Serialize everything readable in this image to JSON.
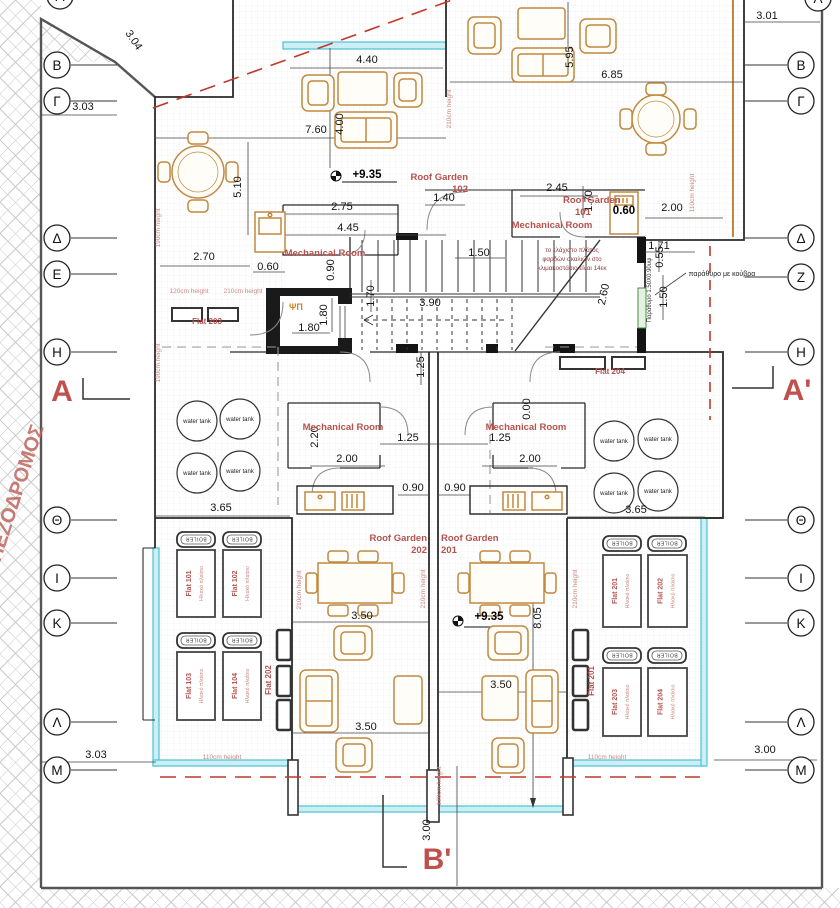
{
  "drawing": {
    "type": "architectural roof plan",
    "pedestrian_street_label": "ΠΕΖΟΔΡΟΜΟΣ",
    "accent_colors": {
      "annotation_red": "#b5524e",
      "section_red": "#c0504d",
      "glass_teal": "#49c3d4",
      "furniture_tan": "#c08840",
      "setback_dash_red": "#c0392b"
    }
  },
  "grid_markers": {
    "left": [
      [
        "Β",
        65
      ],
      [
        "Γ",
        101
      ],
      [
        "Δ",
        238
      ],
      [
        "Ε",
        274
      ],
      [
        "Η",
        352
      ],
      [
        "Θ",
        520
      ],
      [
        "Ι",
        578
      ],
      [
        "Κ",
        623
      ],
      [
        "Λ",
        722
      ],
      [
        "Μ",
        770
      ]
    ],
    "right": [
      [
        "Β",
        65
      ],
      [
        "Γ",
        101
      ],
      [
        "Δ",
        238
      ],
      [
        "Ζ",
        277
      ],
      [
        "Η",
        352
      ],
      [
        "Θ",
        520
      ],
      [
        "Ι",
        578
      ],
      [
        "Κ",
        623
      ],
      [
        "Λ",
        722
      ],
      [
        "Μ",
        770
      ]
    ],
    "top_partial_letter": "Α"
  },
  "section_markers": [
    {
      "t": "A",
      "x": 62,
      "y": 401
    },
    {
      "t": "A'",
      "x": 797,
      "y": 400
    },
    {
      "t": "B'",
      "x": 437,
      "y": 869
    }
  ],
  "water_tank_label": "water tank",
  "water_tanks": [
    [
      197,
      421
    ],
    [
      240,
      419
    ],
    [
      197,
      473
    ],
    [
      240,
      471
    ],
    [
      614,
      441
    ],
    [
      658,
      439
    ],
    [
      614,
      493
    ],
    [
      658,
      491
    ]
  ],
  "solar_panel_sub_label": "Ηλιακό πλαίσιο",
  "boiler_label": "BOILER",
  "solar_panels": [
    [
      "Flat 101",
      177,
      550,
      38,
      67
    ],
    [
      "Flat 102",
      223,
      550,
      38,
      67
    ],
    [
      "Flat 103",
      177,
      652,
      38,
      68
    ],
    [
      "Flat 104",
      223,
      652,
      38,
      68
    ],
    [
      "Flat 201",
      603,
      555,
      38,
      72
    ],
    [
      "Flat 202",
      648,
      555,
      39,
      72
    ],
    [
      "Flat 203",
      603,
      668,
      38,
      68
    ],
    [
      "Flat 204",
      648,
      668,
      39,
      68
    ]
  ],
  "boilers": [
    [
      177,
      532
    ],
    [
      223,
      532
    ],
    [
      177,
      633
    ],
    [
      223,
      633
    ],
    [
      603,
      536
    ],
    [
      648,
      536
    ],
    [
      603,
      648
    ],
    [
      648,
      648
    ]
  ],
  "texts": [
    {
      "t": "3.01",
      "x": 767,
      "y": 19,
      "c": "dim"
    },
    {
      "t": "3.04",
      "x": 131,
      "y": 42,
      "r": 56,
      "c": "dim"
    },
    {
      "t": "3.03",
      "x": 83,
      "y": 110,
      "c": "dim"
    },
    {
      "t": "4.40",
      "x": 367,
      "y": 63,
      "c": "dim"
    },
    {
      "t": "6.85",
      "x": 612,
      "y": 78,
      "c": "dim"
    },
    {
      "t": "5.95",
      "x": 573,
      "y": 57,
      "r": -90,
      "c": "dim"
    },
    {
      "t": "7.60",
      "x": 316,
      "y": 133,
      "c": "dim"
    },
    {
      "t": "4.00",
      "x": 343,
      "y": 124,
      "r": -90,
      "c": "dim"
    },
    {
      "t": "5.10",
      "x": 241,
      "y": 187,
      "r": -90,
      "c": "dim"
    },
    {
      "t": "1.40",
      "x": 444,
      "y": 201,
      "c": "dim"
    },
    {
      "t": "2.45",
      "x": 557,
      "y": 191,
      "c": "dim"
    },
    {
      "t": "1.70",
      "x": 592,
      "y": 201,
      "r": -90,
      "c": "dim"
    },
    {
      "t": "0.60",
      "x": 624,
      "y": 214,
      "c": "dimb"
    },
    {
      "t": "2.00",
      "x": 672,
      "y": 211,
      "c": "dim"
    },
    {
      "t": "2.75",
      "x": 342,
      "y": 210,
      "c": "dim"
    },
    {
      "t": "4.45",
      "x": 348,
      "y": 231,
      "c": "dim"
    },
    {
      "t": "2.70",
      "x": 204,
      "y": 260,
      "c": "dim"
    },
    {
      "t": "0.60",
      "x": 268,
      "y": 270,
      "c": "dim"
    },
    {
      "t": "1.50",
      "x": 479,
      "y": 256,
      "c": "dim"
    },
    {
      "t": "1.71",
      "x": 659,
      "y": 249,
      "c": "dim"
    },
    {
      "t": "0.55",
      "x": 663,
      "y": 257,
      "r": -90,
      "c": "dim"
    },
    {
      "t": "1.50",
      "x": 667,
      "y": 297,
      "r": -90,
      "c": "dim"
    },
    {
      "t": "1.80",
      "x": 309,
      "y": 331,
      "c": "dim"
    },
    {
      "t": "1.80",
      "x": 327,
      "y": 315,
      "r": -90,
      "c": "dim"
    },
    {
      "t": "0.90",
      "x": 334,
      "y": 270,
      "r": -90,
      "c": "dim"
    },
    {
      "t": "1.70",
      "x": 374,
      "y": 296,
      "r": -90,
      "c": "dim"
    },
    {
      "t": "3.90",
      "x": 430,
      "y": 306,
      "c": "dim"
    },
    {
      "t": "2.60",
      "x": 607,
      "y": 295,
      "r": -78,
      "c": "dim"
    },
    {
      "t": "1.25",
      "x": 424,
      "y": 367,
      "r": -90,
      "c": "dim"
    },
    {
      "t": "0.00",
      "x": 530,
      "y": 409,
      "r": -90,
      "c": "dim"
    },
    {
      "t": "2.20",
      "x": 318,
      "y": 437,
      "r": -90,
      "c": "dim"
    },
    {
      "t": "1.25",
      "x": 408,
      "y": 441,
      "c": "dim"
    },
    {
      "t": "1.25",
      "x": 500,
      "y": 441,
      "c": "dim"
    },
    {
      "t": "2.00",
      "x": 347,
      "y": 462,
      "c": "dim"
    },
    {
      "t": "2.00",
      "x": 530,
      "y": 462,
      "c": "dim"
    },
    {
      "t": "0.90",
      "x": 413,
      "y": 491,
      "c": "dim"
    },
    {
      "t": "0.90",
      "x": 455,
      "y": 491,
      "c": "dim"
    },
    {
      "t": "3.65",
      "x": 221,
      "y": 511,
      "c": "dim"
    },
    {
      "t": "3.65",
      "x": 636,
      "y": 513,
      "c": "dim"
    },
    {
      "t": "3.50",
      "x": 362,
      "y": 619,
      "c": "dim"
    },
    {
      "t": "3.50",
      "x": 366,
      "y": 730,
      "c": "dim"
    },
    {
      "t": "3.50",
      "x": 501,
      "y": 688,
      "c": "dim"
    },
    {
      "t": "8.05",
      "x": 541,
      "y": 618,
      "r": -90,
      "c": "dim"
    },
    {
      "t": "+9.35",
      "x": 367,
      "y": 178,
      "c": "dimb"
    },
    {
      "t": "+9.35",
      "x": 489,
      "y": 620,
      "c": "dimb"
    },
    {
      "t": "3.03",
      "x": 96,
      "y": 758,
      "c": "dim"
    },
    {
      "t": "3.00",
      "x": 765,
      "y": 753,
      "c": "dim"
    },
    {
      "t": "3.00",
      "x": 430,
      "y": 830,
      "r": -90,
      "c": "dim"
    },
    {
      "t": "Roof Garden",
      "x": 468,
      "y": 180,
      "c": "room",
      "a": "end"
    },
    {
      "t": "102",
      "x": 468,
      "y": 192,
      "c": "room",
      "a": "end"
    },
    {
      "t": "Roof Garden",
      "x": 563,
      "y": 203,
      "c": "room",
      "a": "start"
    },
    {
      "t": "101",
      "x": 575,
      "y": 215,
      "c": "room",
      "a": "start"
    },
    {
      "t": "Mechanical Room",
      "x": 552,
      "y": 228,
      "c": "room"
    },
    {
      "t": "Mechanical Room",
      "x": 325,
      "y": 256,
      "c": "room"
    },
    {
      "t": "Mechanical Room",
      "x": 343,
      "y": 430,
      "c": "room"
    },
    {
      "t": "Mechanical Room",
      "x": 526,
      "y": 430,
      "c": "room"
    },
    {
      "t": "Roof Garden",
      "x": 427,
      "y": 541,
      "c": "room",
      "a": "end"
    },
    {
      "t": "202",
      "x": 427,
      "y": 553,
      "c": "room",
      "a": "end"
    },
    {
      "t": "Roof Garden",
      "x": 441,
      "y": 541,
      "c": "room",
      "a": "start"
    },
    {
      "t": "201",
      "x": 441,
      "y": 553,
      "c": "room",
      "a": "start"
    },
    {
      "t": "Flat 203",
      "x": 207,
      "y": 324,
      "c": "roomS"
    },
    {
      "t": "Flat 204",
      "x": 610,
      "y": 374,
      "c": "roomS"
    },
    {
      "t": "Flat 202",
      "x": 271,
      "y": 680,
      "r": -90,
      "c": "roomS"
    },
    {
      "t": "Flat 201",
      "x": 594,
      "y": 681,
      "r": -90,
      "c": "roomS"
    },
    {
      "t": "120cm height",
      "x": 189,
      "y": 293,
      "c": "ht"
    },
    {
      "t": "210cm height",
      "x": 243,
      "y": 293,
      "c": "ht"
    },
    {
      "t": "190cm height",
      "x": 160,
      "y": 228,
      "r": -90,
      "c": "ht"
    },
    {
      "t": "190cm height",
      "x": 160,
      "y": 363,
      "r": -90,
      "c": "ht"
    },
    {
      "t": "210cm height",
      "x": 451,
      "y": 109,
      "r": -90,
      "c": "ht"
    },
    {
      "t": "110cm height",
      "x": 694,
      "y": 193,
      "r": -90,
      "c": "ht"
    },
    {
      "t": "210cm height",
      "x": 301,
      "y": 590,
      "r": -90,
      "c": "ht"
    },
    {
      "t": "210cm height",
      "x": 425,
      "y": 589,
      "r": -90,
      "c": "ht"
    },
    {
      "t": "210cm height",
      "x": 577,
      "y": 589,
      "r": -90,
      "c": "ht"
    },
    {
      "t": "110cm height",
      "x": 222,
      "y": 759,
      "c": "ht"
    },
    {
      "t": "110cm height",
      "x": 607,
      "y": 759,
      "c": "ht"
    },
    {
      "t": "120cm height",
      "x": 441,
      "y": 786,
      "r": -90,
      "c": "ht"
    },
    {
      "t": "το ελάχιστο πλάτος",
      "x": 572,
      "y": 252,
      "c": "note"
    },
    {
      "t": "φαρδών σκαλιών στο",
      "x": 572,
      "y": 261,
      "c": "note"
    },
    {
      "t": "κλιμακοστάσιο είναι 14εκ",
      "x": 572,
      "y": 270,
      "c": "note"
    },
    {
      "t": "παράθυρο με κούβρα",
      "x": 722,
      "y": 276,
      "c": "blk7"
    },
    {
      "t": "Παράθυρο 1.50Χ0.90υψ",
      "x": 651,
      "y": 290,
      "r": -90,
      "c": "blk6"
    },
    {
      "t": "ΨΠ",
      "x": 296,
      "y": 310,
      "c": "lift"
    }
  ]
}
